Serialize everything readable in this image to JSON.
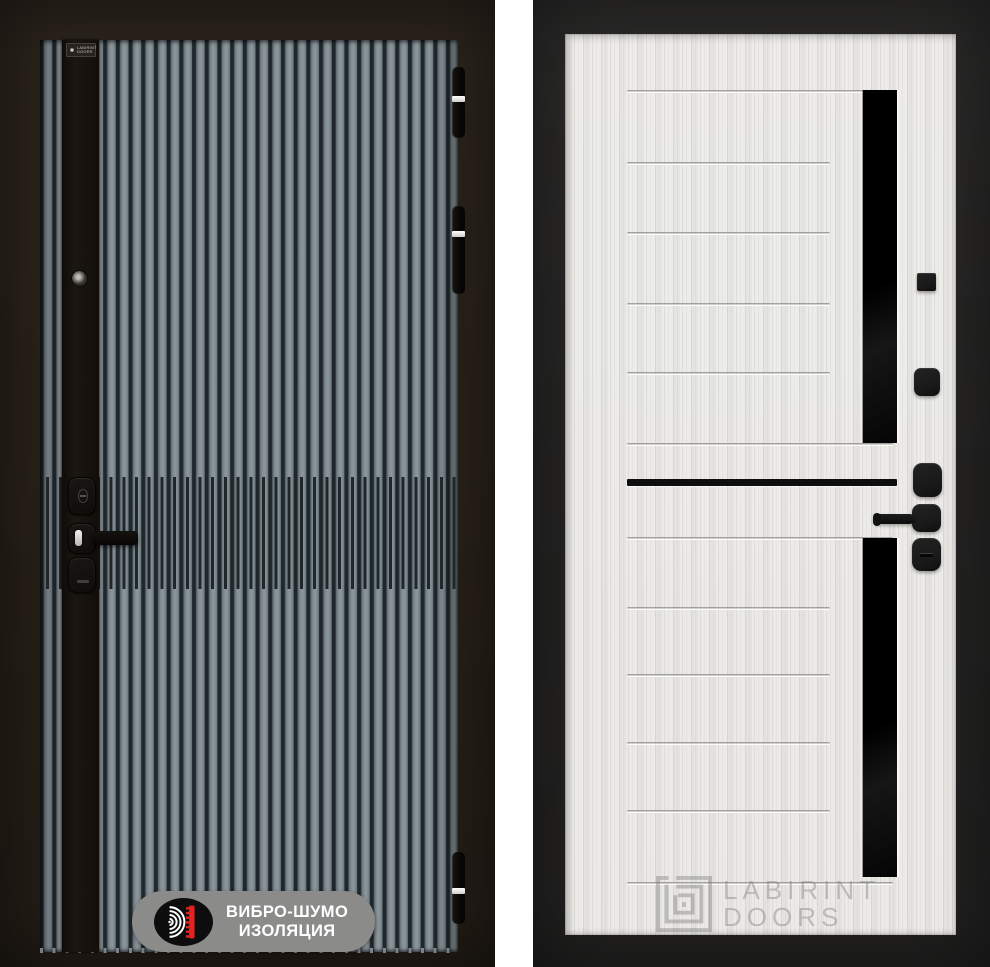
{
  "left_door": {
    "brand_plate": {
      "line1": "LABIRINT",
      "line2": "DOORS"
    },
    "badge": {
      "line1": "ВИБРО-ШУМО",
      "line2": "ИЗОЛЯЦИЯ",
      "icon": "sound-wave-insulation-icon"
    },
    "features": [
      "peephole",
      "cylinder-lock-upper",
      "door-handle-lever",
      "cylinder-lock-lower",
      "three-hinges"
    ]
  },
  "right_door": {
    "watermark": {
      "line1": "LABIRINT",
      "line2": "DOORS",
      "icon": "labirint-maze-logo-icon"
    },
    "features": [
      "black-glass-insert-upper",
      "black-glass-insert-lower",
      "black-accent-line",
      "door-handle-lever",
      "lock-escutcheon"
    ]
  },
  "colors": {
    "left_slat": "#7e8a90",
    "left_groove": "#20272b",
    "left_strip": "#1b1611",
    "badge_pill": "#8b8b89",
    "badge_circle": "#0d0d0d",
    "badge_red": "#e4231f",
    "badge_text": "#ffffff",
    "right_panel": "#ecebe8",
    "right_glass": "#050505",
    "right_hardware": "#1a1a1a",
    "accent_line": "#0e0e0e",
    "watermark": "rgba(125,123,119,0.42)"
  }
}
